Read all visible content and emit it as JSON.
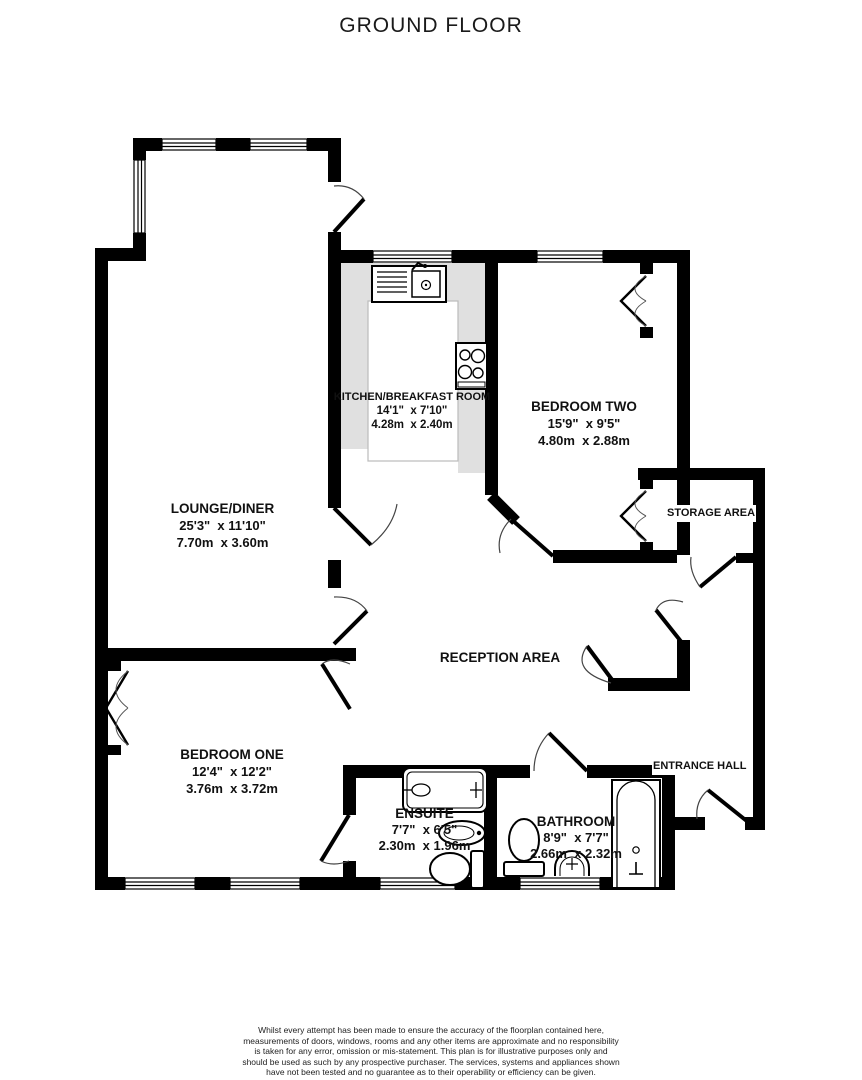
{
  "title": "GROUND FLOOR",
  "rooms": {
    "lounge": {
      "name": "LOUNGE/DINER",
      "imperial": "25'3\"  x 11'10\"",
      "metric": "7.70m  x 3.60m"
    },
    "kitchen": {
      "name": "KITCHEN/BREAKFAST ROOM",
      "imperial": "14'1\"  x 7'10\"",
      "metric": "4.28m  x 2.40m"
    },
    "bedroom_two": {
      "name": "BEDROOM TWO",
      "imperial": "15'9\"  x 9'5\"",
      "metric": "4.80m  x 2.88m"
    },
    "bedroom_one": {
      "name": "BEDROOM ONE",
      "imperial": "12'4\"  x 12'2\"",
      "metric": "3.76m  x 3.72m"
    },
    "ensuite": {
      "name": "ENSUITE",
      "imperial": "7'7\"  x 6'5\"",
      "metric": "2.30m  x 1.96m"
    },
    "bathroom": {
      "name": "BATHROOM",
      "imperial": "8'9\"  x 7'7\"",
      "metric": "2.66m  x 2.32m"
    },
    "reception": {
      "name": "RECEPTION AREA"
    },
    "storage": {
      "name": "STORAGE AREA"
    },
    "entrance_hall": {
      "name": "ENTRANCE HALL"
    }
  },
  "footer": {
    "disclaimer": "Whilst every attempt has been made to ensure the accuracy of the floorplan contained here, measurements of doors, windows, rooms and any other items are approximate and no responsibility is taken for any error, omission or mis-statement. This plan is for illustrative purposes only and should be used as such by any prospective purchaser. The services, systems and appliances shown have not been tested and no guarantee as to their operability or efficiency can be given.",
    "credit": "Made with Metropix ©2026"
  },
  "colors": {
    "wall": "#000000",
    "counter": "#e0e0e0",
    "swing_arc": "#444444"
  }
}
